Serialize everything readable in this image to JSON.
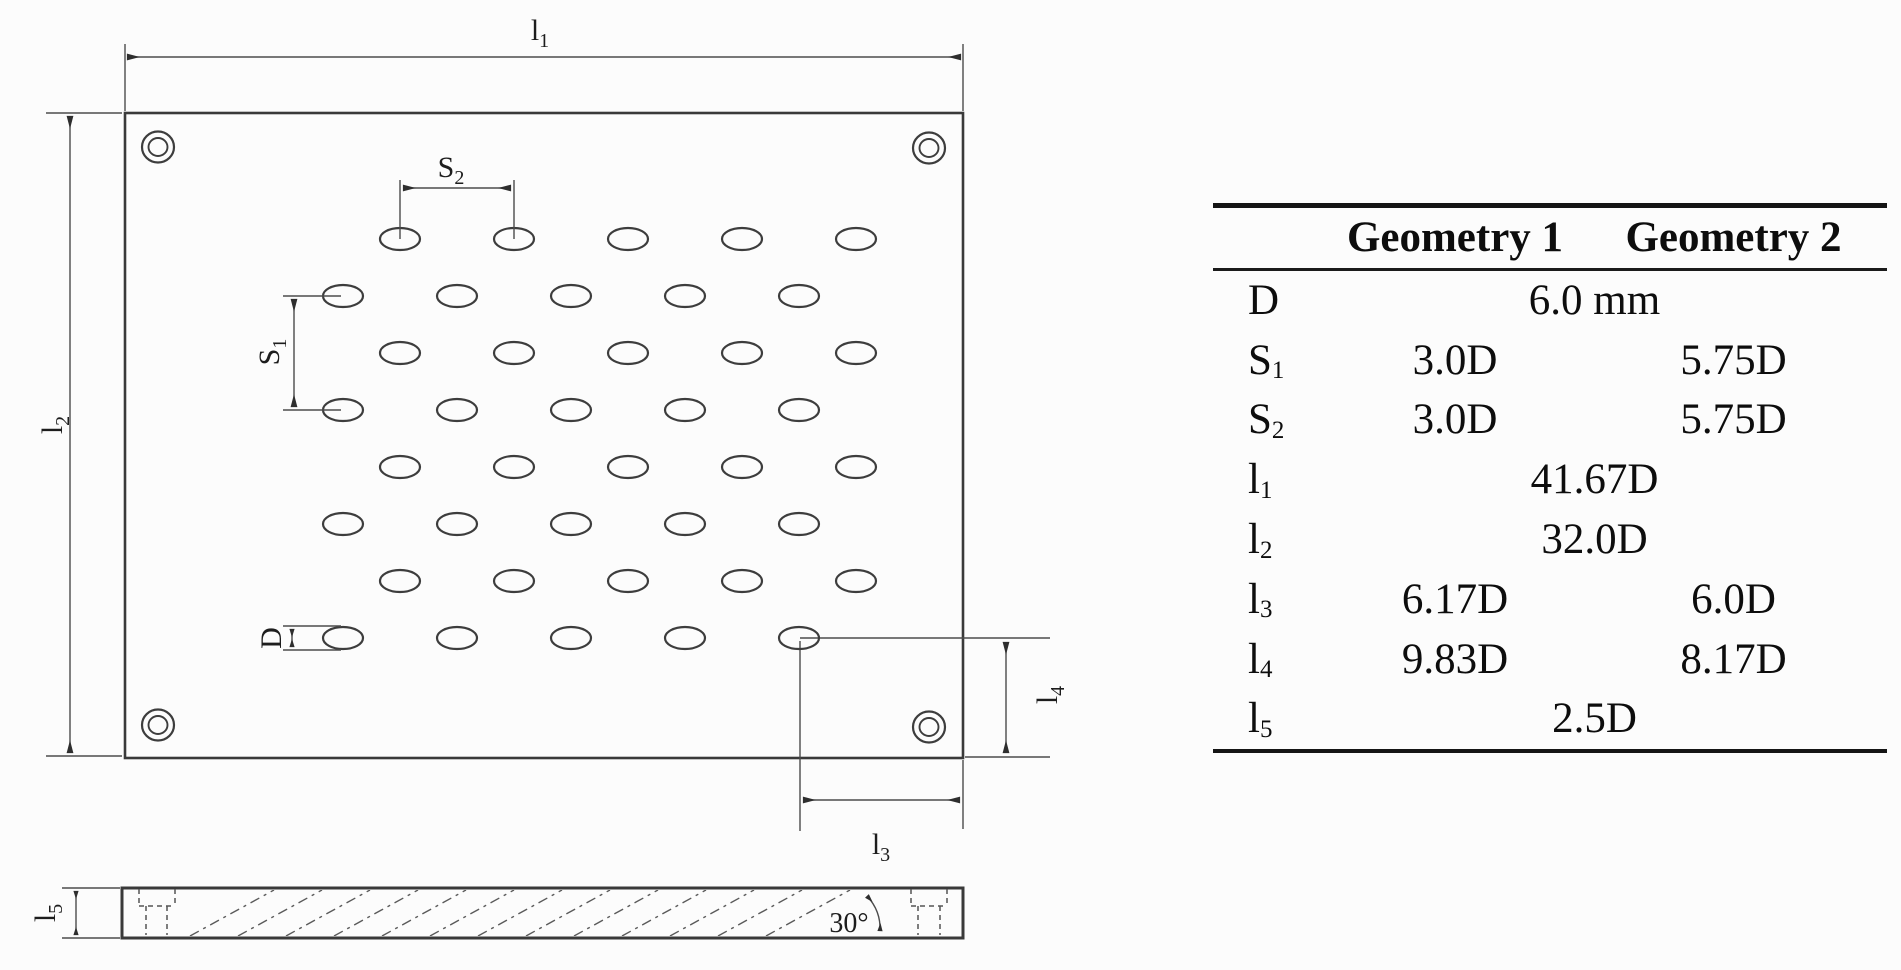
{
  "drawing": {
    "labels": {
      "l1": {
        "main": "l",
        "sub": "1"
      },
      "l2": {
        "main": "l",
        "sub": "2"
      },
      "l3": {
        "main": "l",
        "sub": "3"
      },
      "l4": {
        "main": "l",
        "sub": "4"
      },
      "l5": {
        "main": "l",
        "sub": "5"
      },
      "s1": {
        "main": "S",
        "sub": "1"
      },
      "s2": {
        "main": "S",
        "sub": "2"
      },
      "d": {
        "main": "D",
        "sub": ""
      },
      "angle": "30°"
    }
  },
  "table": {
    "headers": {
      "col1": "Geometry 1",
      "col2": "Geometry 2"
    },
    "rows": [
      {
        "label": {
          "main": "D",
          "sub": ""
        },
        "span": "6.0 mm"
      },
      {
        "label": {
          "main": "S",
          "sub": "1"
        },
        "g1": "3.0D",
        "g2": "5.75D"
      },
      {
        "label": {
          "main": "S",
          "sub": "2"
        },
        "g1": "3.0D",
        "g2": "5.75D"
      },
      {
        "label": {
          "main": "l",
          "sub": "1"
        },
        "span": "41.67D"
      },
      {
        "label": {
          "main": "l",
          "sub": "2"
        },
        "span": "32.0D"
      },
      {
        "label": {
          "main": "l",
          "sub": "3"
        },
        "g1": "6.17D",
        "g2": "6.0D"
      },
      {
        "label": {
          "main": "l",
          "sub": "4"
        },
        "g1": "9.83D",
        "g2": "8.17D"
      },
      {
        "label": {
          "main": "l",
          "sub": "5"
        },
        "span": "2.5D"
      }
    ]
  }
}
